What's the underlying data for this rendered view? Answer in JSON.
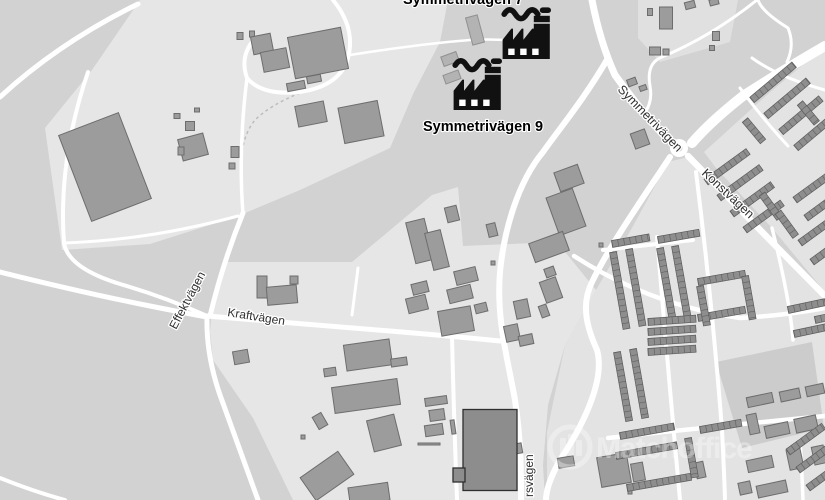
{
  "map": {
    "background": "#d2d2d2",
    "colors": {
      "road": "#ffffff",
      "light_industrial": "#e6e6e6",
      "residential_bg": "#e3e3e3",
      "field": "#cccccc",
      "building_fill": "#9c9c9c",
      "building_stroke": "#6d6d6d",
      "building_dark_fill": "#8d8d8d",
      "building_dark_stroke": "#2f2f2f",
      "building_lite_fill": "#b3b3b3",
      "building_lite_stroke": "#909090",
      "house_fill": "#8e8e8e",
      "house_stroke": "#5c5c5c",
      "label": "#2f2f2f",
      "poi": "#111111"
    },
    "light_areas": [
      {
        "fill": "#e3e3e3",
        "points": "688,157 825,297 825,500 547,500 547,432 565,345 596,290 632,228 668,162"
      },
      {
        "fill": "#e3e3e3",
        "points": "825,46 768,94 704,152 716,168 772,228 825,292"
      },
      {
        "fill": "#cccccc",
        "points": "716,362 812,342 824,428 742,448"
      },
      {
        "fill": "#e6e6e6",
        "points": "140,0 448,0 440,42 414,92 390,148 300,190 238,216 150,244 62,250 45,128 92,70"
      },
      {
        "fill": "#e6e6e6",
        "points": "210,332 212,307 225,262 352,262 432,195 458,187 463,246 557,242 596,290 565,345 548,405 543,465 545,500 293,500 253,418 213,360"
      },
      {
        "fill": "#e0e0e0",
        "points": "638,0 738,0 730,42 660,62 638,38"
      }
    ],
    "roads": [
      {
        "d": "M0,97 Q60,42 138,4",
        "w": 5
      },
      {
        "d": "M88,72 Q58,160 64,243 Q68,268 120,284 Q165,297 207,316",
        "w": 4
      },
      {
        "d": "M0,272 Q80,292 150,306 Q185,313 207,317",
        "w": 5
      },
      {
        "d": "M64,243 Q150,240 238,216",
        "w": 3
      },
      {
        "d": "M247,78 Q238,150 243,214",
        "w": 3.5
      },
      {
        "d": "M333,0 Q356,28 348,58 Q340,86 300,92 Q262,96 247,78 Q240,58 252,42",
        "w": 4
      },
      {
        "d": "M350,55 Q420,44 470,40 Q505,38 540,44",
        "w": 2.5
      },
      {
        "d": "M243,213 Q223,262 210,316",
        "w": 5
      },
      {
        "d": "M207,316 Q206,355 220,395 Q240,450 258,500",
        "w": 5
      },
      {
        "d": "M207,316 Q300,324 390,331 Q450,336 500,341",
        "w": 5
      },
      {
        "d": "M452,336 Q454,420 457,500",
        "w": 4
      },
      {
        "d": "M0,478 Q35,492 65,500",
        "w": 4
      },
      {
        "d": "M352,315 L358,268",
        "w": 3
      },
      {
        "d": "M592,0 Q600,42 615,75 Q642,112 667,139",
        "w": 7
      },
      {
        "d": "M825,46 Q780,72 743,96 Q710,122 692,143",
        "w": 10
      },
      {
        "d": "M608,58 C585,98 560,128 543,152 C518,182 504,230 500,272 C496,320 508,360 515,400 C521,440 521,470 521,500",
        "w": 6
      },
      {
        "d": "M670,157 C643,198 610,245 592,282 C580,306 588,330 597,350 C606,382 580,430 560,460 C550,478 546,490 546,500",
        "w": 6
      },
      {
        "d": "M688,156 Q756,226 825,296",
        "w": 6.5
      },
      {
        "d": "M574,256 Q650,305 740,318 Q790,315 825,308",
        "w": 4.5
      },
      {
        "d": "M608,438 Q700,428 825,416",
        "w": 4.5
      },
      {
        "d": "M657,237 Q668,370 680,500",
        "w": 4
      },
      {
        "d": "M696,172 Q712,300 722,430 Q724,468 725,500",
        "w": 4
      },
      {
        "d": "M772,228 Q790,300 793,340",
        "w": 3.5
      },
      {
        "d": "M800,440 Q802,470 803,500",
        "w": 3.5
      },
      {
        "d": "M603,250 L693,240",
        "w": 4
      },
      {
        "d": "M757,0 Q712,36 662,57 Q646,63 650,86 Q653,102 644,114",
        "w": 3
      },
      {
        "d": "M758,0 Q762,12 788,28 Q795,45 787,62",
        "w": 3
      },
      {
        "d": "M825,90 Q780,78 752,58",
        "w": 3
      },
      {
        "d": "M740,88 Q762,118 788,146",
        "w": 3
      }
    ],
    "paths_minor": [
      {
        "d": "M300,93 Q270,105 255,120 Q245,132 242,152",
        "w": 1.5
      }
    ],
    "roundabout": {
      "cx": 679,
      "cy": 148,
      "r": 9,
      "inner_r": 3.5
    },
    "buildings": [
      [
        105,
        167,
        64,
        92,
        -21
      ],
      [
        193,
        147,
        26,
        22,
        -15
      ],
      [
        190,
        126,
        9,
        9,
        0
      ],
      [
        177,
        116,
        6,
        5,
        0
      ],
      [
        197,
        110,
        5,
        4,
        0
      ],
      [
        181,
        151,
        6,
        8,
        0
      ],
      [
        240,
        36,
        6,
        7,
        0
      ],
      [
        252,
        34,
        5,
        6,
        0
      ],
      [
        235,
        152,
        8,
        11,
        0
      ],
      [
        232,
        166,
        6,
        6,
        0
      ],
      [
        318,
        53,
        54,
        42,
        -11
      ],
      [
        262,
        44,
        20,
        18,
        -11
      ],
      [
        275,
        60,
        26,
        20,
        -11
      ],
      [
        296,
        86,
        18,
        8,
        -11
      ],
      [
        314,
        79,
        14,
        7,
        -11
      ],
      [
        311,
        114,
        29,
        21,
        -11
      ],
      [
        361,
        122,
        40,
        36,
        -11
      ],
      [
        450,
        59,
        16,
        10,
        -20,
        "L"
      ],
      [
        452,
        77,
        16,
        9,
        -20,
        "L"
      ],
      [
        475,
        30,
        12,
        28,
        -15,
        "L"
      ],
      [
        420,
        241,
        19,
        42,
        -14
      ],
      [
        437,
        250,
        16,
        38,
        -14
      ],
      [
        452,
        214,
        12,
        15,
        -14
      ],
      [
        492,
        230,
        9,
        13,
        -14
      ],
      [
        493,
        263,
        4,
        4,
        0
      ],
      [
        466,
        276,
        22,
        14,
        -14
      ],
      [
        460,
        294,
        24,
        14,
        -14
      ],
      [
        420,
        288,
        16,
        11,
        -14
      ],
      [
        417,
        304,
        20,
        15,
        -14
      ],
      [
        481,
        308,
        12,
        9,
        -14
      ],
      [
        456,
        321,
        33,
        25,
        -10
      ],
      [
        569,
        178,
        25,
        20,
        -20
      ],
      [
        566,
        212,
        28,
        40,
        -20
      ],
      [
        549,
        247,
        36,
        20,
        -20
      ],
      [
        550,
        272,
        10,
        9,
        -20
      ],
      [
        551,
        290,
        17,
        22,
        -20
      ],
      [
        544,
        311,
        8,
        12,
        -20
      ],
      [
        522,
        309,
        14,
        18,
        -12
      ],
      [
        512,
        333,
        14,
        16,
        -12
      ],
      [
        526,
        340,
        14,
        10,
        -12
      ],
      [
        515,
        449,
        14,
        10,
        -10
      ],
      [
        632,
        82,
        9,
        7,
        -20
      ],
      [
        643,
        88,
        7,
        5,
        -20
      ],
      [
        640,
        139,
        15,
        16,
        -20
      ],
      [
        601,
        245,
        4,
        4,
        0
      ],
      [
        262,
        287,
        10,
        22,
        0
      ],
      [
        282,
        295,
        30,
        18,
        -5
      ],
      [
        294,
        280,
        8,
        8,
        0
      ],
      [
        241,
        357,
        15,
        13,
        -10
      ],
      [
        368,
        355,
        46,
        26,
        -8
      ],
      [
        399,
        362,
        16,
        8,
        -8
      ],
      [
        366,
        396,
        66,
        26,
        -8
      ],
      [
        384,
        433,
        28,
        32,
        -14
      ],
      [
        436,
        401,
        22,
        8,
        -8
      ],
      [
        437,
        415,
        15,
        11,
        -8
      ],
      [
        434,
        430,
        18,
        11,
        -8
      ],
      [
        453,
        427,
        4,
        14,
        -8
      ],
      [
        429,
        444,
        22,
        2,
        0
      ],
      [
        330,
        372,
        12,
        8,
        -8
      ],
      [
        320,
        421,
        10,
        14,
        -30
      ],
      [
        303,
        437,
        4,
        4,
        0
      ],
      [
        490,
        450,
        54,
        81,
        0,
        "D"
      ],
      [
        459,
        475,
        12,
        14,
        0,
        "D"
      ],
      [
        327,
        476,
        46,
        28,
        -35
      ],
      [
        369,
        494,
        40,
        18,
        -8
      ],
      [
        566,
        462,
        16,
        10,
        -10
      ],
      [
        614,
        470,
        30,
        30,
        -10
      ],
      [
        638,
        472,
        12,
        18,
        -10
      ],
      [
        630,
        492,
        4,
        4,
        0
      ],
      [
        666,
        18,
        13,
        22,
        0
      ],
      [
        650,
        12,
        5,
        7,
        0
      ],
      [
        690,
        5,
        10,
        7,
        -15
      ],
      [
        714,
        2,
        9,
        6,
        -15
      ],
      [
        655,
        51,
        11,
        8,
        0
      ],
      [
        666,
        52,
        6,
        6,
        0
      ],
      [
        716,
        36,
        7,
        9,
        0
      ],
      [
        712,
        48,
        5,
        5,
        0
      ],
      [
        760,
        400,
        26,
        10,
        -12
      ],
      [
        790,
        395,
        20,
        10,
        -12
      ],
      [
        815,
        390,
        18,
        10,
        -12
      ],
      [
        753,
        424,
        10,
        20,
        -12
      ],
      [
        777,
        430,
        24,
        12,
        -12
      ],
      [
        806,
        424,
        22,
        14,
        -12
      ],
      [
        760,
        464,
        26,
        12,
        -12
      ],
      [
        795,
        459,
        14,
        20,
        -12
      ],
      [
        819,
        455,
        12,
        18,
        -12
      ],
      [
        772,
        489,
        30,
        12,
        -12
      ],
      [
        745,
        488,
        12,
        12,
        -12
      ],
      [
        700,
        470,
        9,
        16,
        -12
      ]
    ],
    "house_rows": [
      [
        752,
        100,
        55,
        -40
      ],
      [
        766,
        116,
        55,
        -40
      ],
      [
        781,
        132,
        52,
        -40
      ],
      [
        796,
        148,
        48,
        -40
      ],
      [
        745,
        120,
        28,
        50
      ],
      [
        800,
        103,
        26,
        50
      ],
      [
        706,
        182,
        52,
        -36
      ],
      [
        719,
        198,
        52,
        -36
      ],
      [
        732,
        214,
        50,
        -36
      ],
      [
        745,
        230,
        46,
        -36
      ],
      [
        762,
        194,
        30,
        54
      ],
      [
        778,
        212,
        30,
        54
      ],
      [
        795,
        200,
        42,
        -36
      ],
      [
        806,
        218,
        42,
        -36
      ],
      [
        800,
        243,
        40,
        -36
      ],
      [
        812,
        262,
        36,
        -36
      ],
      [
        613,
        252,
        78,
        80
      ],
      [
        629,
        249,
        78,
        80
      ],
      [
        660,
        248,
        72,
        80
      ],
      [
        675,
        246,
        72,
        80
      ],
      [
        612,
        244,
        38,
        -10
      ],
      [
        658,
        240,
        42,
        -10
      ],
      [
        698,
        282,
        48,
        -10
      ],
      [
        698,
        318,
        48,
        -10
      ],
      [
        700,
        286,
        40,
        80
      ],
      [
        745,
        276,
        44,
        80
      ],
      [
        648,
        322,
        48,
        -4
      ],
      [
        648,
        332,
        48,
        -4
      ],
      [
        648,
        342,
        48,
        -4
      ],
      [
        648,
        352,
        48,
        -4
      ],
      [
        617,
        352,
        70,
        80
      ],
      [
        633,
        349,
        70,
        80
      ],
      [
        620,
        436,
        55,
        -10
      ],
      [
        616,
        456,
        62,
        -10
      ],
      [
        627,
        488,
        65,
        -10
      ],
      [
        688,
        438,
        40,
        80
      ],
      [
        700,
        430,
        42,
        -10
      ],
      [
        788,
        452,
        44,
        -36
      ],
      [
        798,
        470,
        44,
        -36
      ],
      [
        808,
        488,
        40,
        -36
      ],
      [
        788,
        310,
        38,
        -12
      ],
      [
        815,
        320,
        32,
        -12
      ],
      [
        794,
        334,
        38,
        -12
      ]
    ],
    "street_labels": [
      {
        "text": "Symmetrivägen",
        "x": 617,
        "y": 90,
        "rot": 46,
        "size": 12.5
      },
      {
        "text": "Konstvägen",
        "x": 701,
        "y": 174,
        "rot": 43,
        "size": 12.5
      },
      {
        "text": "Effektvägen",
        "x": 176,
        "y": 330,
        "rot": -62,
        "size": 12
      },
      {
        "text": "Kraftvägen",
        "x": 227,
        "y": 316,
        "rot": 9,
        "size": 12
      },
      {
        "text": "rsvägen",
        "x": 533,
        "y": 497,
        "rot": -90,
        "size": 12
      }
    ],
    "poi": {
      "factories": [
        {
          "x": 501,
          "y": 3,
          "scale": 0.8
        },
        {
          "x": 452,
          "y": 54,
          "scale": 0.8
        }
      ],
      "labels": [
        {
          "text": "Symmetrivägen 7",
          "x": 403,
          "y": 4,
          "size": 14.5
        },
        {
          "text": "Symmetrivägen 9",
          "x": 423,
          "y": 131,
          "size": 14.5
        }
      ]
    },
    "watermark": {
      "text": "Matchoffice",
      "cx": 570,
      "cy": 447,
      "r": 20,
      "tx": 596,
      "ty": 458,
      "size": 30,
      "opacity": 0.35
    }
  }
}
